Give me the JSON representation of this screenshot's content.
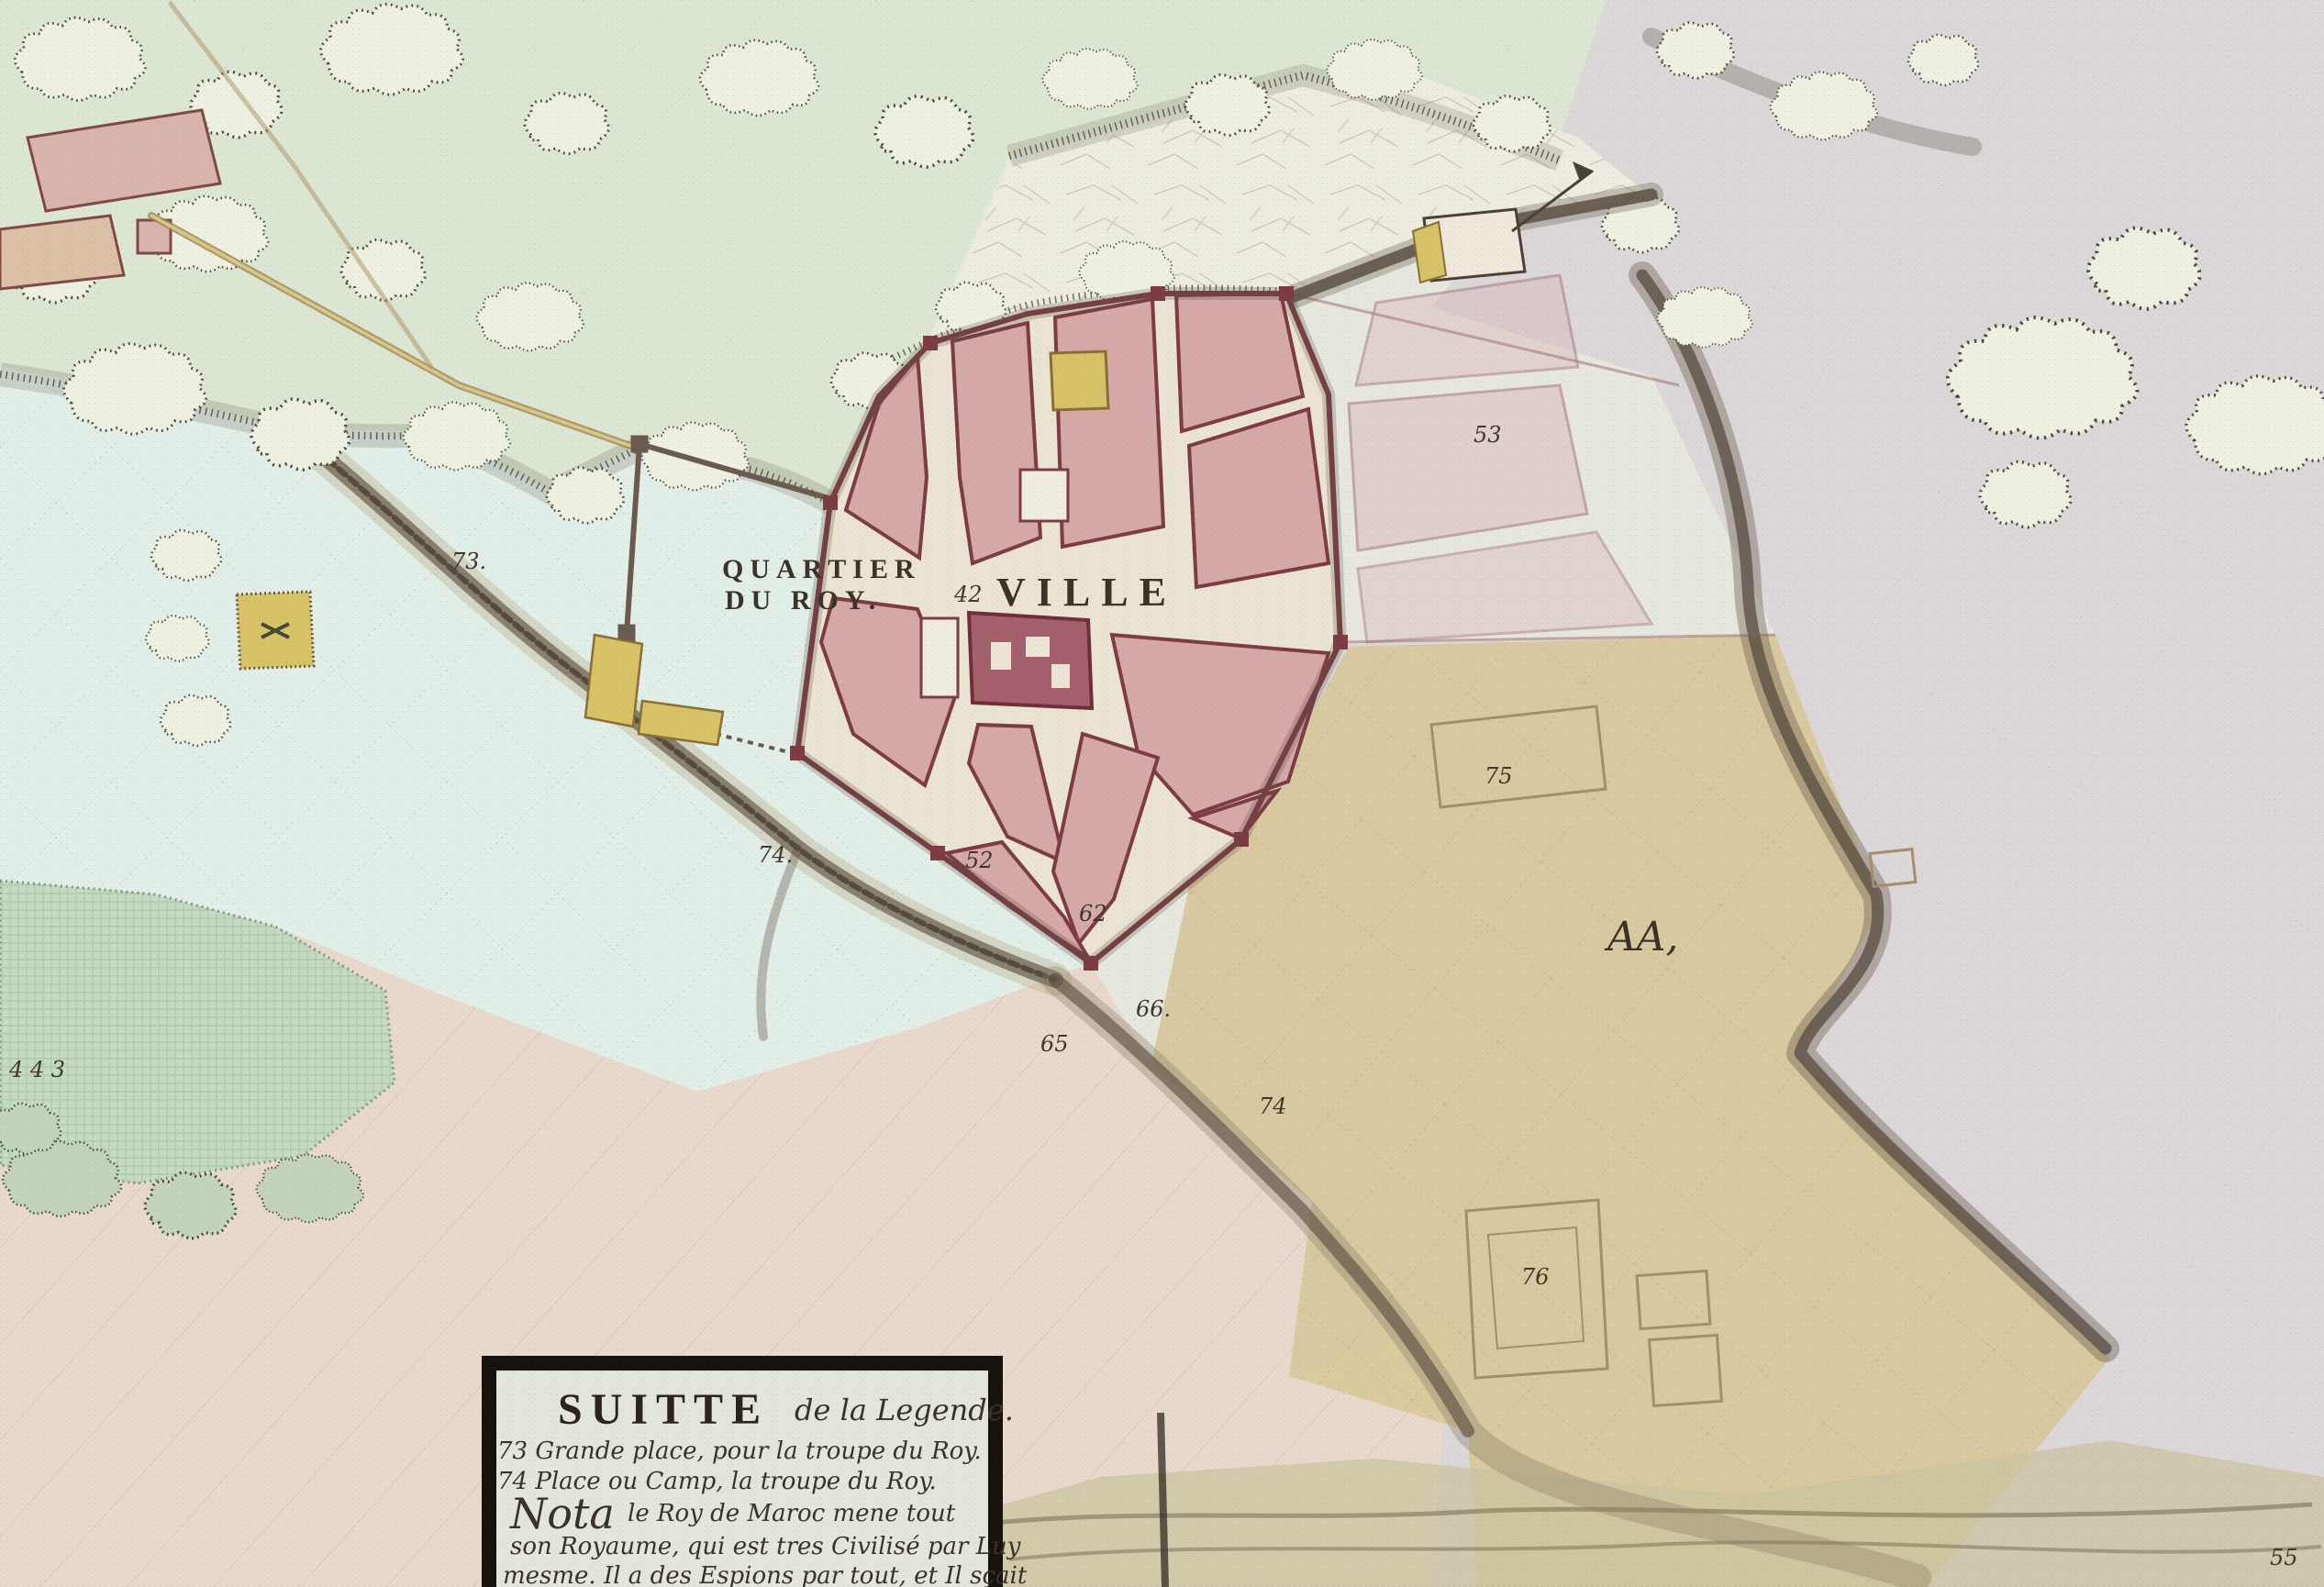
{
  "map": {
    "labels": {
      "quartier_line1": "QUARTIER",
      "quartier_line2": "DU ROY.",
      "ville_num": "42",
      "ville": "VILLE",
      "aa": "AA,"
    },
    "numbers": [
      {
        "text": "73."
      },
      {
        "text": "74."
      },
      {
        "text": "52"
      },
      {
        "text": "53"
      },
      {
        "text": "75"
      },
      {
        "text": "74"
      },
      {
        "text": "65"
      },
      {
        "text": "66."
      },
      {
        "text": "62"
      },
      {
        "text": "76"
      },
      {
        "text": "55"
      },
      {
        "text": "4 4 3"
      }
    ],
    "colors": {
      "paper": "#e6e8df",
      "woods_green": "#dce7d3",
      "plain_blue": "#e2efe9",
      "plain_gray": "#dcd8da",
      "field_tan": "#d8c795",
      "town_pink": "#d5a9a8",
      "wall_red": "#7d3b44",
      "accent_yellow": "#d7c268",
      "ink": "#3b3327"
    }
  },
  "legend": {
    "title_caps": "SUITTE",
    "title_script": "de la Legende.",
    "line1": "73 Grande place, pour la troupe du Roy.",
    "line2": "74 Place ou Camp, la troupe du Roy.",
    "nota_word": "Nota",
    "nota_rest": "le Roy de Maroc mene tout",
    "line4": "son Royaume, qui est tres Civilisé par Luy",
    "line5": "mesme. Il a des Espions par tout, et Il sçait"
  }
}
